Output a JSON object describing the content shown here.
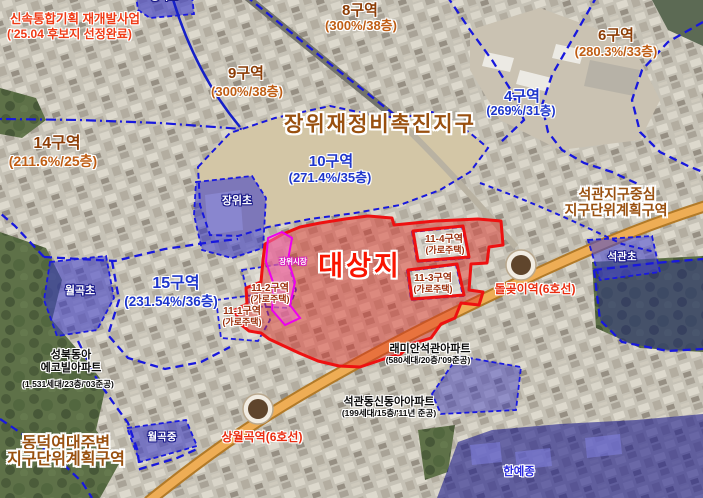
{
  "note": {
    "line1": "신속통합기획 재개발사업",
    "line2": "('25.04 후보지 선정완료)"
  },
  "district_title": "장위재정비촉진지구",
  "site_label": "대상지",
  "market_label": "장위시장",
  "zones": [
    {
      "name": "8구역",
      "value": "(300%/38층)"
    },
    {
      "name": "9구역",
      "value": "(300%/38층)"
    },
    {
      "name": "6구역",
      "value": "(280.3%/33층)"
    },
    {
      "name": "4구역",
      "value": "(269%/31층)"
    },
    {
      "name": "14구역",
      "value": "(211.6%/25층)"
    },
    {
      "name": "10구역",
      "value": "(271.4%/35층)"
    },
    {
      "name": "15구역",
      "value": "(231.54%/36층)"
    }
  ],
  "street_housing_zones": [
    {
      "name": "11-1구역",
      "value": "(가로주택)"
    },
    {
      "name": "11-2구역",
      "value": "(가로주택)"
    },
    {
      "name": "11-3구역",
      "value": "(가로주택)"
    },
    {
      "name": "11-4구역",
      "value": "(가로주택)"
    }
  ],
  "plan_districts": {
    "seokgwan": {
      "line1": "석관지구중심",
      "line2": "지구단위계획구역"
    },
    "dongduk": {
      "line1": "동덕여대주변",
      "line2": "지구단위계획구역"
    }
  },
  "stations": [
    {
      "name": "돌곶이역(6호선)"
    },
    {
      "name": "상월곡역(6호선)"
    }
  ],
  "schools": [
    {
      "name": "장곡초"
    },
    {
      "name": "장위초"
    },
    {
      "name": "월곡초"
    },
    {
      "name": "석관초"
    },
    {
      "name": "월곡중"
    },
    {
      "name": "한예종"
    }
  ],
  "apartments": [
    {
      "name": "래미안석관아파트",
      "value": "(580세대/20층/'09준공)"
    },
    {
      "name": "석관동신동아아파트",
      "value": "(199세대/15층/'11년 준공)"
    },
    {
      "line1": "성북동아",
      "line2": "에코빌아파트",
      "value": "(1,531세대/23층/'03준공)"
    }
  ],
  "colors": {
    "site_boundary": "#ee1111",
    "zone_boundary": "#1818dd",
    "market_boundary": "#ee00ee",
    "road": "#eead55",
    "zone_label_brown": "#8c3d05",
    "zone_label_blue": "#1d35cc"
  }
}
